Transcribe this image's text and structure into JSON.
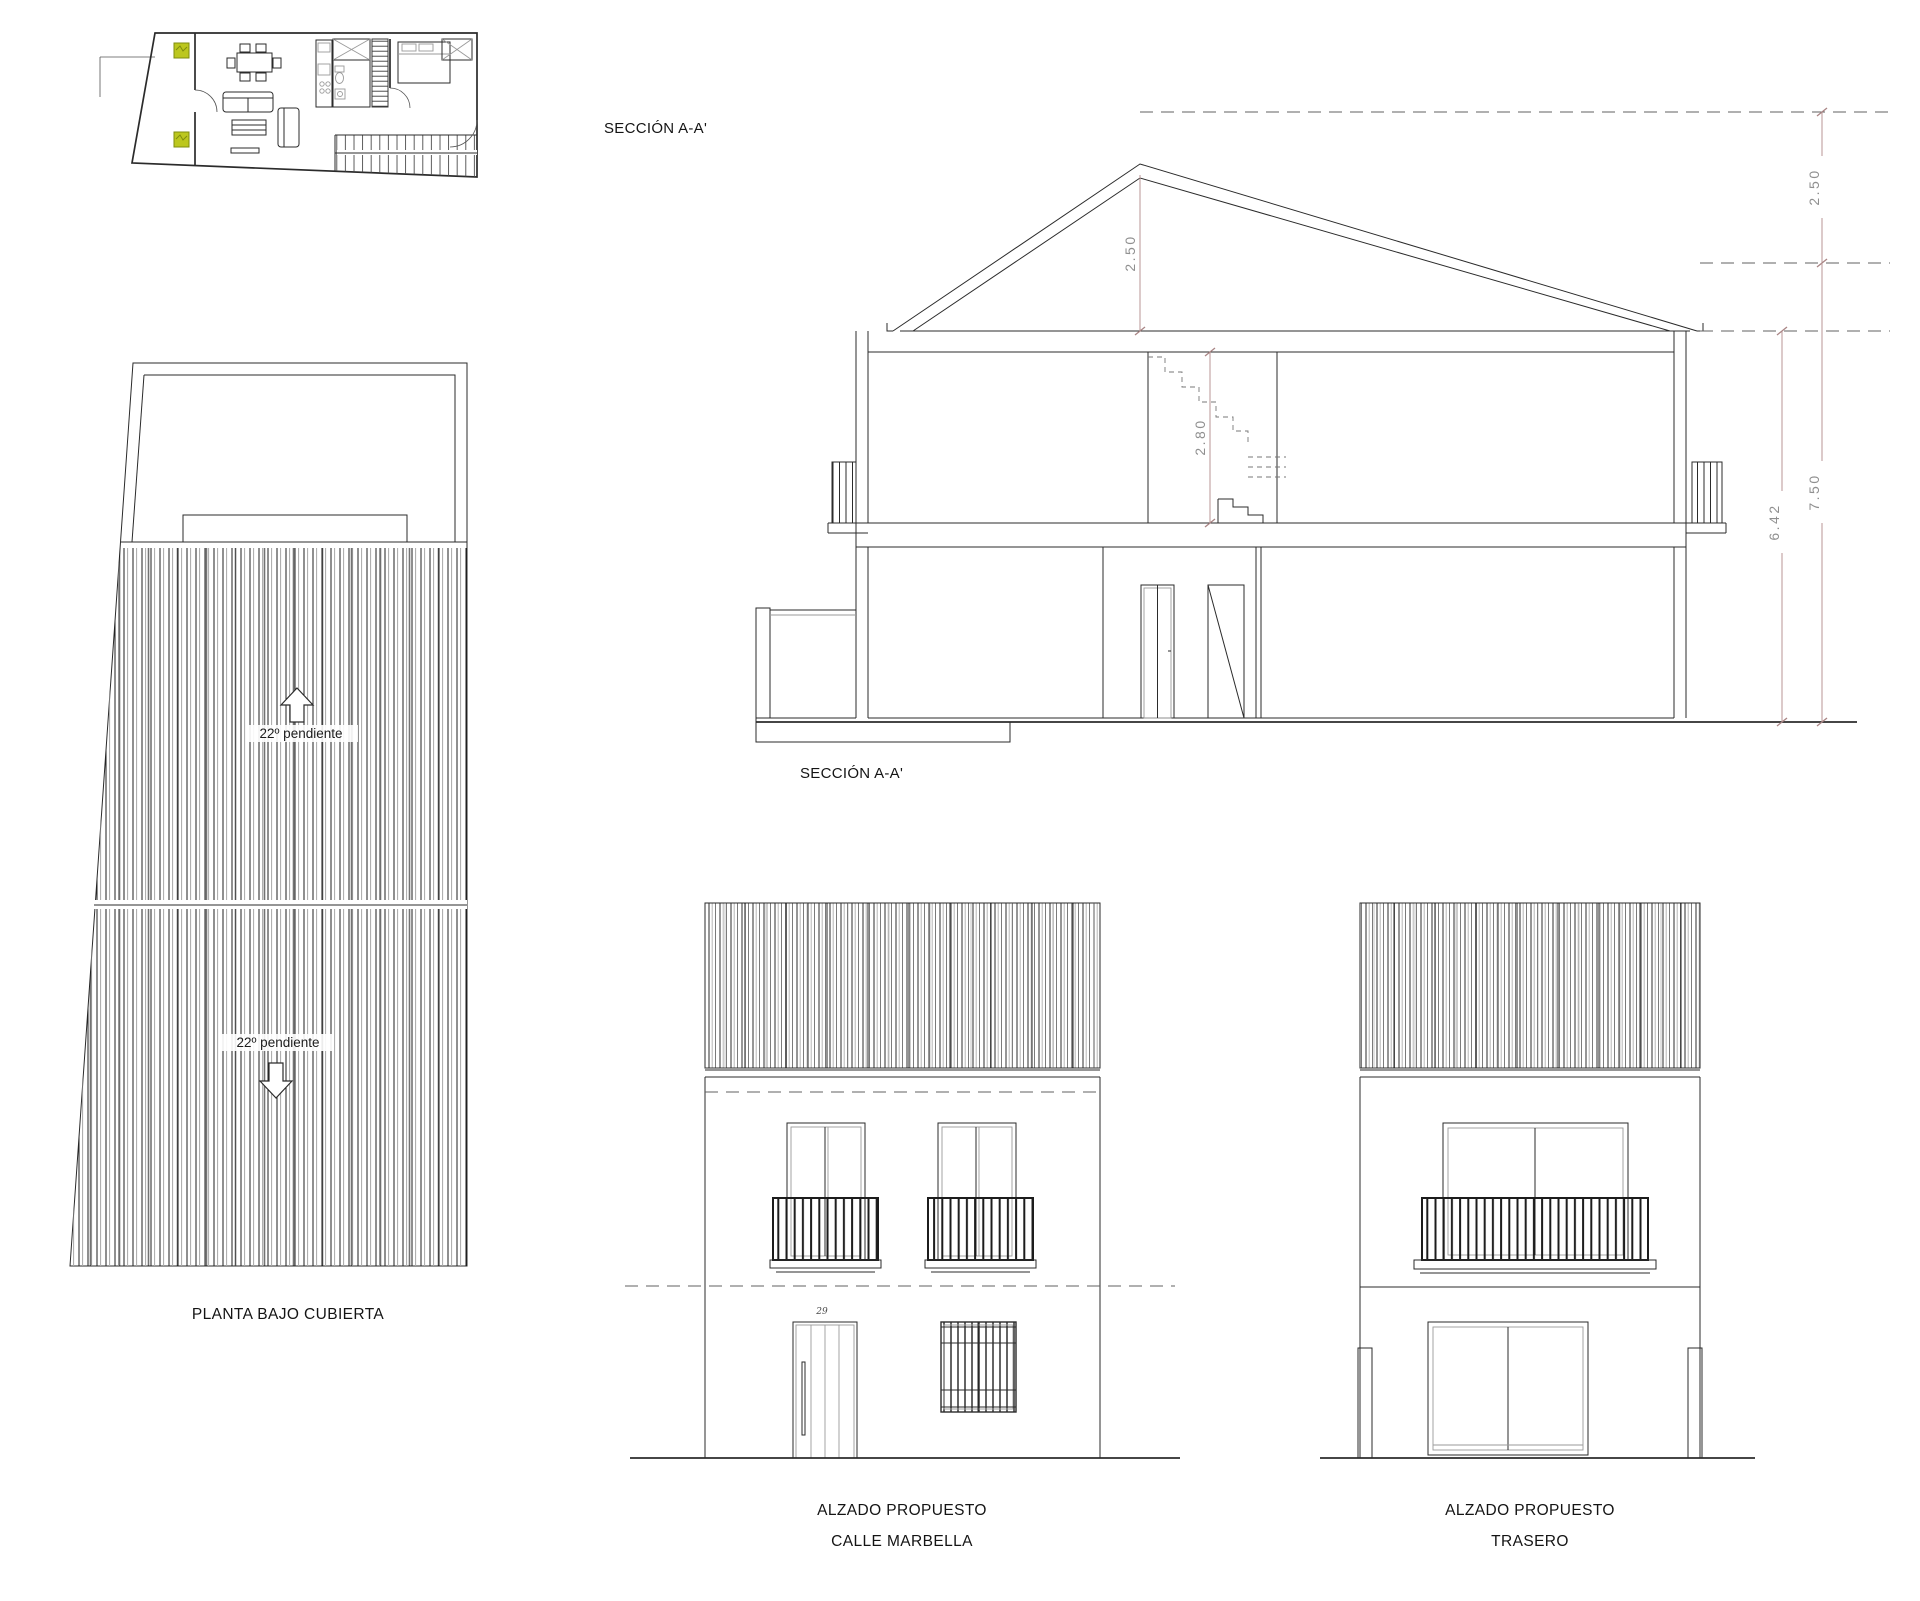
{
  "sheet": {
    "background": "#ffffff",
    "line_color": "#2b2b2b",
    "dim_line_color": "#b89494",
    "dim_text_color": "#8f8f8f",
    "plant_color": "#bcc71e"
  },
  "labels": {
    "section_title_top": "SECCIÓN A-A'",
    "section_title_bottom": "SECCIÓN A-A'",
    "roof_plan_title": "PLANTA BAJO CUBIERTA",
    "roof_slope_upper": "22º pendiente",
    "roof_slope_lower": "22º pendiente",
    "front_elevation_title_1": "ALZADO PROPUESTO",
    "front_elevation_title_2": "CALLE MARBELLA",
    "rear_elevation_title_1": "ALZADO PROPUESTO",
    "rear_elevation_title_2": "TRASERO",
    "door_number": "29"
  },
  "dimensions": {
    "ridge_height": "2.50",
    "upper_floor_height": "2.80",
    "parapet_height": "2.50",
    "eaves_height": "6.42",
    "total_height": "7.50"
  }
}
